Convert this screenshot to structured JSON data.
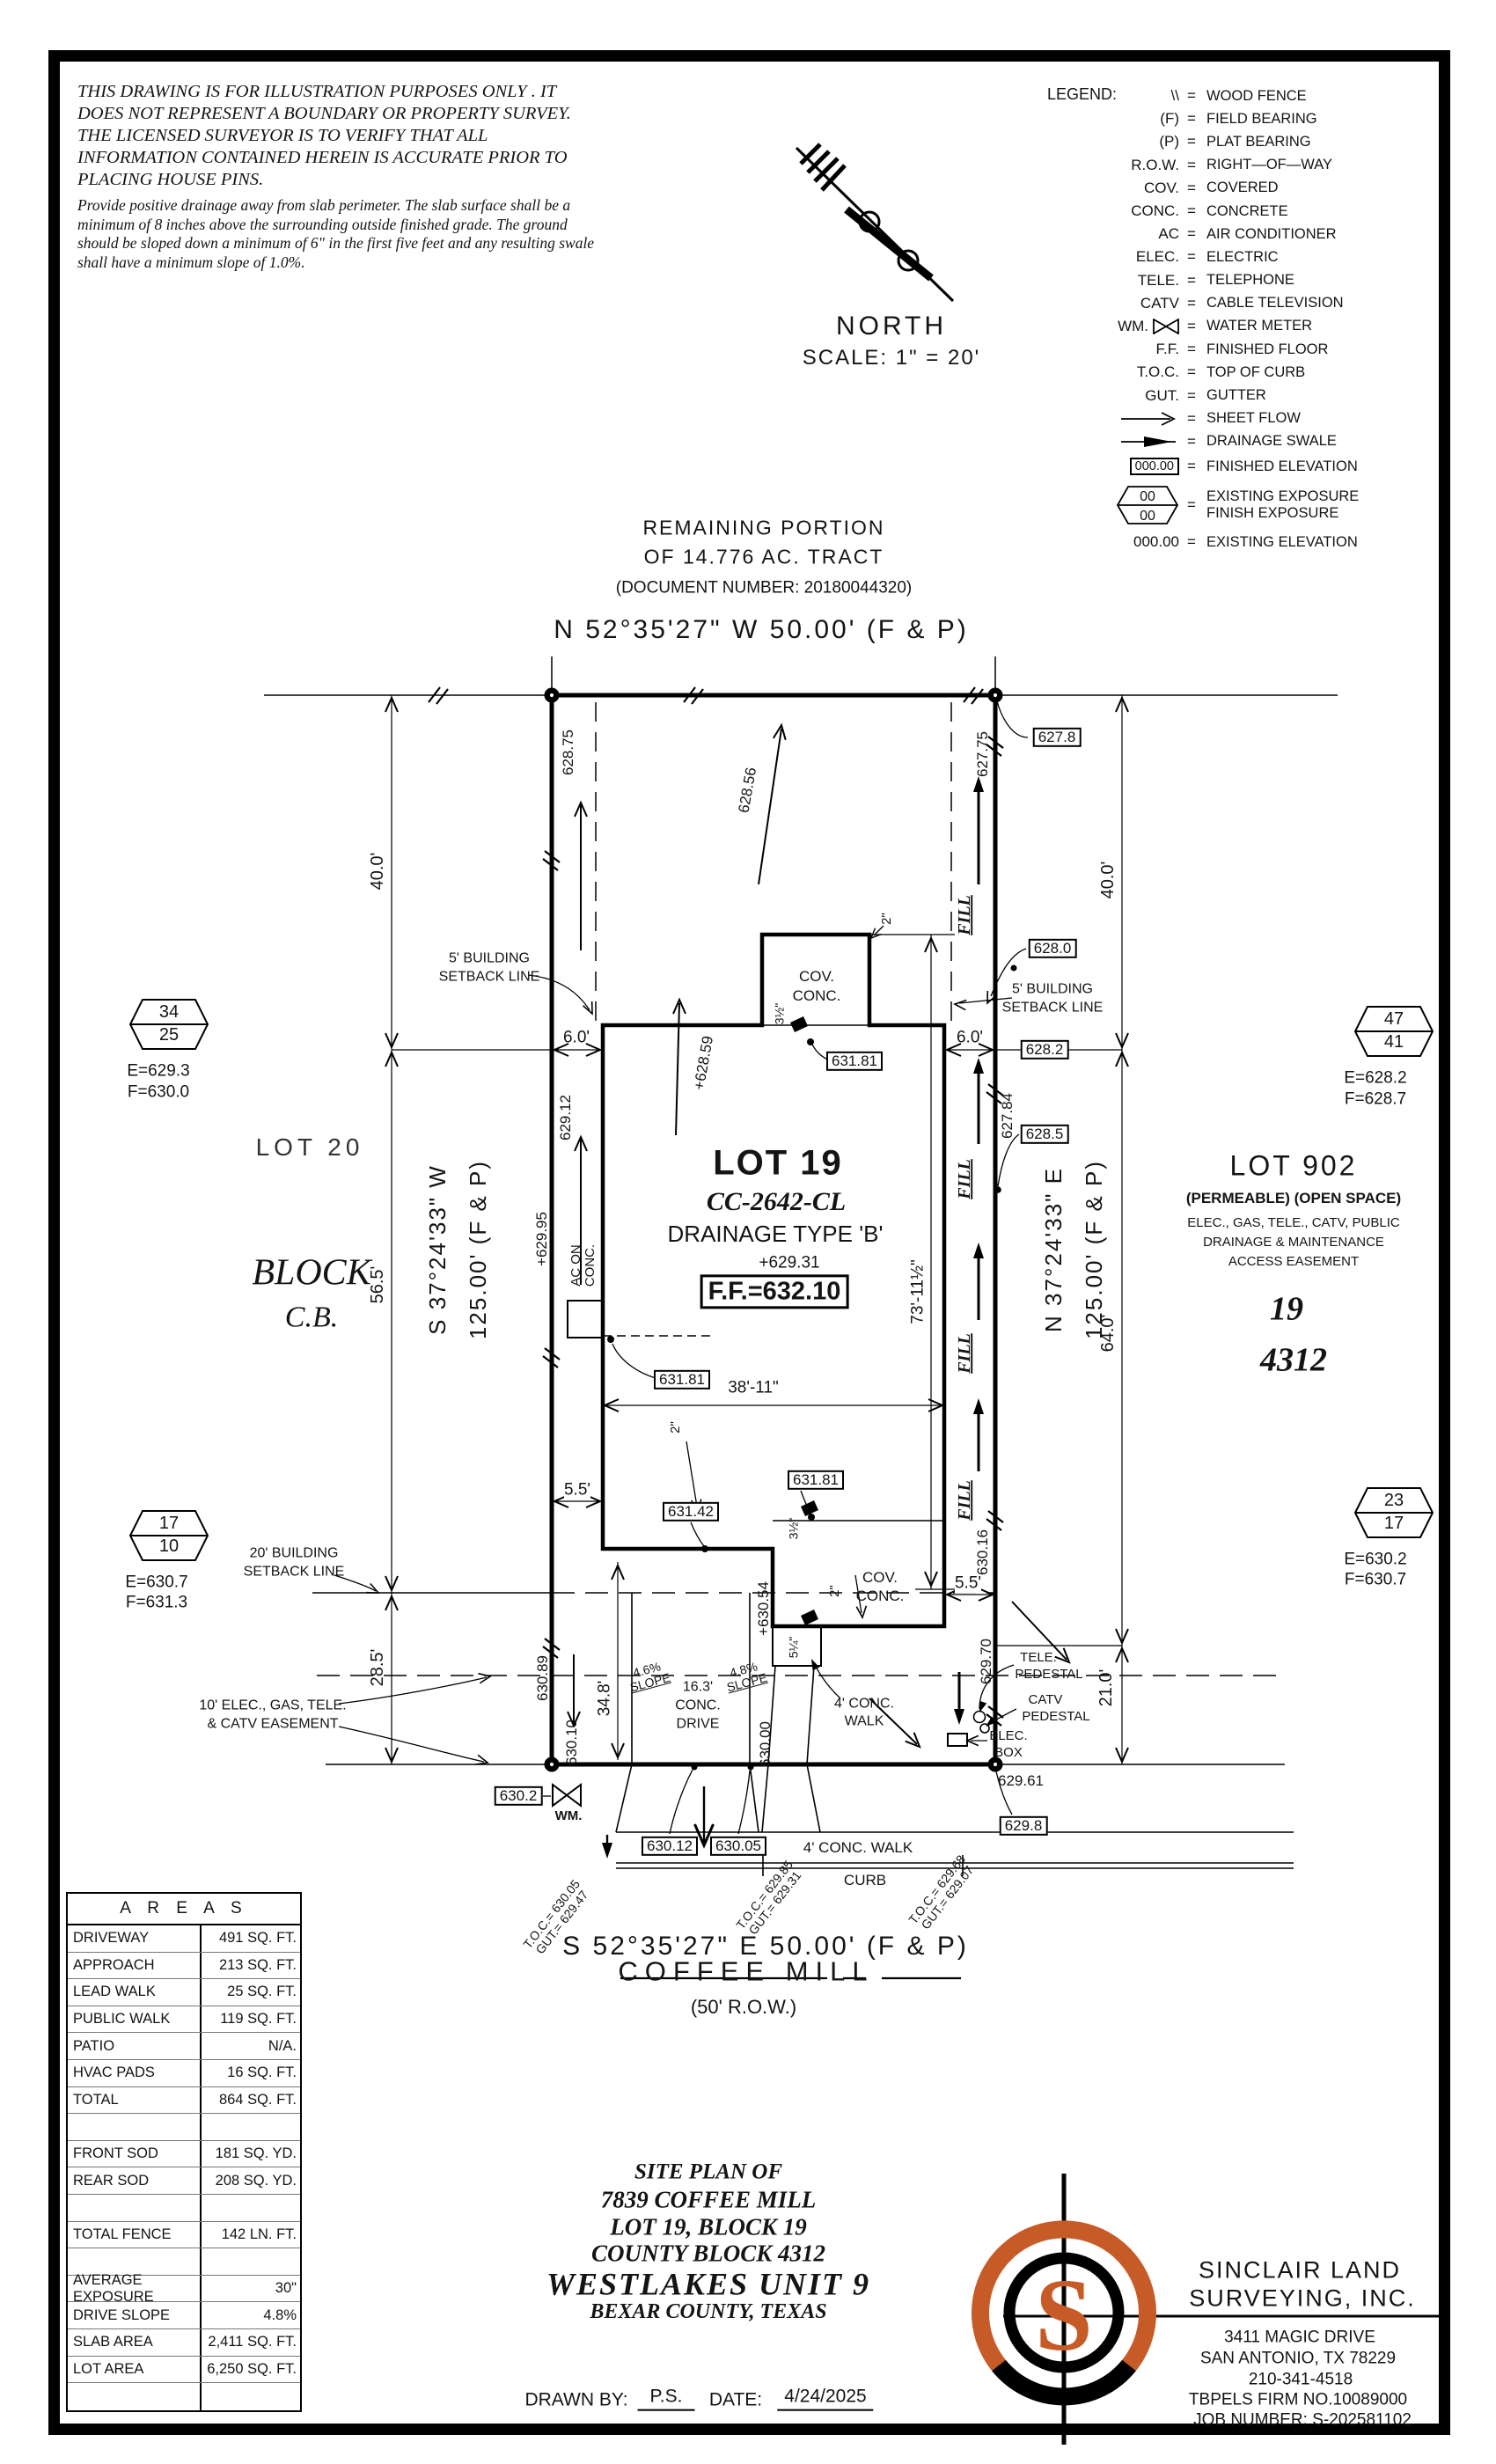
{
  "sheet": {
    "disclaimer_para1": "THIS DRAWING IS FOR ILLUSTRATION PURPOSES ONLY . IT DOES NOT REPRESENT A BOUNDARY OR PROPERTY SURVEY. THE LICENSED SURVEYOR IS TO VERIFY THAT ALL INFORMATION CONTAINED HEREIN IS ACCURATE PRIOR TO PLACING HOUSE PINS.",
    "disclaimer_para2": "Provide positive drainage away from slab perimeter. The slab surface shall be a minimum of 8 inches above the surrounding outside finished grade. The ground should be sloped down a minimum of 6\" in the first five feet and any resulting swale shall have a minimum slope of 1.0%."
  },
  "legend": {
    "title": "LEGEND:",
    "eq": "=",
    "hex_top": "00",
    "hex_bot": "00",
    "rows": [
      {
        "sym": "\\\\",
        "desc": "WOOD FENCE"
      },
      {
        "sym": "(F)",
        "desc": "FIELD BEARING"
      },
      {
        "sym": "(P)",
        "desc": "PLAT BEARING"
      },
      {
        "sym": "R.O.W.",
        "desc": "RIGHT—OF—WAY"
      },
      {
        "sym": "COV.",
        "desc": "COVERED"
      },
      {
        "sym": "CONC.",
        "desc": "CONCRETE"
      },
      {
        "sym": "AC",
        "desc": "AIR CONDITIONER"
      },
      {
        "sym": "ELEC.",
        "desc": "ELECTRIC"
      },
      {
        "sym": "TELE.",
        "desc": "TELEPHONE"
      },
      {
        "sym": "CATV",
        "desc": "CABLE TELEVISION"
      },
      {
        "sym": "WM.",
        "desc": "WATER METER"
      },
      {
        "sym": "F.F.",
        "desc": "FINISHED FLOOR"
      },
      {
        "sym": "T.O.C.",
        "desc": "TOP OF CURB"
      },
      {
        "sym": "GUT.",
        "desc": "GUTTER"
      },
      {
        "sym": "",
        "desc": "SHEET FLOW"
      },
      {
        "sym": "",
        "desc": "DRAINAGE SWALE"
      },
      {
        "sym": "000.00",
        "desc": "FINISHED ELEVATION"
      },
      {
        "sym": "",
        "desc": "EXISTING EXPOSURE",
        "desc2": "FINISH EXPOSURE"
      },
      {
        "sym": "000.00",
        "desc": "EXISTING ELEVATION"
      }
    ]
  },
  "north": {
    "label": "NORTH",
    "scale": "SCALE: 1\" = 20'"
  },
  "tract": {
    "line1": "REMAINING PORTION",
    "line2": "OF 14.776 AC. TRACT",
    "line3": "(DOCUMENT NUMBER: 20180044320)"
  },
  "bearing_north": "N 52°35'27\" W 50.00' (F & P)",
  "bearing_south": "S 52°35'27\" E 50.00' (F & P)",
  "bearing_west": {
    "dir": "S 37°24'33\" W",
    "len": "125.00' (F & P)"
  },
  "bearing_east": {
    "dir": "N 37°24'33\" E",
    "len": "125.00' (F & P)"
  },
  "street": {
    "name": "COFFEE MILL",
    "row": "(50' R.O.W.)",
    "walk": "4' CONC. WALK",
    "curb": "CURB"
  },
  "lot19": {
    "name": "LOT 19",
    "plan_code": "CC-2642-CL",
    "drainage": "DRAINAGE TYPE 'B'",
    "spot": "+629.31",
    "ff": "F.F.=632.10"
  },
  "lot20": {
    "name": "LOT 20",
    "block1": "BLOCK",
    "block2": "C.B."
  },
  "lot902": {
    "name": "LOT 902",
    "l1": "(PERMEABLE) (OPEN SPACE)",
    "l2": "ELEC., GAS, TELE., CATV, PUBLIC",
    "l3": "DRAINAGE & MAINTENANCE",
    "l4": "ACCESS EASEMENT",
    "block": "19",
    "county_block": "4312"
  },
  "hex": {
    "tl": {
      "top": "34",
      "bot": "25",
      "e": "E=629.3",
      "f": "F=630.0"
    },
    "tr": {
      "top": "47",
      "bot": "41",
      "e": "E=628.2",
      "f": "F=628.7"
    },
    "bl": {
      "top": "17",
      "bot": "10",
      "e": "E=630.7",
      "f": "F=631.3"
    },
    "br": {
      "top": "23",
      "bot": "17",
      "e": "E=630.2",
      "f": "F=630.7"
    }
  },
  "dims": {
    "d40l": "40.0'",
    "d40r": "40.0'",
    "d565": "56.5'",
    "d285": "28.5'",
    "d64": "64.0'",
    "d21": "21.0'",
    "d6l": "6.0'",
    "d6r": "6.0'",
    "d55l": "5.5'",
    "d55r": "5.5'",
    "d3811": "38'-11\"",
    "d7311": "73'-11½\"",
    "d348": "34.8'",
    "d2a": "2\"",
    "d2b": "2\"",
    "d2c": "2\"",
    "d35a": "3½\"",
    "d35b": "3½\"",
    "d525": "5¼\""
  },
  "setbacks": {
    "five_l1": "5' BUILDING",
    "five_l2": "SETBACK LINE",
    "twenty_l1": "20' BUILDING",
    "twenty_l2": "SETBACK LINE",
    "easement_l1": "10' ELEC., GAS, TELE.",
    "easement_l2": "& CATV EASEMENT"
  },
  "drive": {
    "slope1a": "4.6%",
    "slope1b": "SLOPE",
    "w1": "16.3'",
    "w2": "CONC.",
    "w3": "DRIVE",
    "slope2a": "4.8%",
    "slope2b": "SLOPE",
    "walk1": "4' CONC.",
    "walk2": "WALK"
  },
  "features": {
    "cov1a": "COV.",
    "cov1b": "CONC.",
    "cov2a": "COV.",
    "cov2b": "CONC.",
    "ac1": "AC ON",
    "ac2": "CONC.",
    "wm": "WM.",
    "fill": "FILL",
    "tele1": "TELE.",
    "tele2": "PEDESTAL",
    "catv1": "CATV",
    "catv2": "PEDESTAL",
    "elec1": "ELEC.",
    "elec2": "BOX"
  },
  "spot": {
    "e62875": "628.75",
    "e62856": "628.56",
    "e62775": "627.75",
    "e62912": "629.12",
    "e62859": "+628.59",
    "e62784": "627.84",
    "e62995": "+629.95",
    "e63054": "+630.54",
    "e63016": "630.16",
    "e62970": "629.70",
    "e63089": "630.89",
    "e63010": "630.10",
    "e63000": "630.00",
    "e62961": "629.61",
    "b6278": "627.8",
    "b6280": "628.0",
    "b6282": "628.2",
    "b6285": "628.5",
    "b63181a": "631.81",
    "b63181b": "631.81",
    "b63181c": "631.81",
    "b63142": "631.42",
    "b6302": "630.2",
    "b6298": "629.8",
    "b63012": "630.12",
    "b63005": "630.05"
  },
  "toc": {
    "c1l1": "T.O.C.= 630.05",
    "c1l2": "GUT.= 629.47",
    "c2l1": "T.O.C.= 629.85",
    "c2l2": "GUT.= 629.31",
    "c3l1": "T.O.C.= 629.68",
    "c3l2": "GUT.= 629.07"
  },
  "areas_table": {
    "title": "A R E A S",
    "rows": [
      {
        "label": "DRIVEWAY",
        "value": "491 SQ. FT."
      },
      {
        "label": "APPROACH",
        "value": "213 SQ. FT."
      },
      {
        "label": "LEAD WALK",
        "value": "25 SQ. FT."
      },
      {
        "label": "PUBLIC WALK",
        "value": "119 SQ. FT."
      },
      {
        "label": "PATIO",
        "value": "N/A."
      },
      {
        "label": "HVAC PADS",
        "value": "16 SQ. FT."
      },
      {
        "label": "TOTAL",
        "value": "864 SQ. FT."
      },
      {
        "label": "",
        "value": ""
      },
      {
        "label": "FRONT SOD",
        "value": "181 SQ. YD."
      },
      {
        "label": "REAR SOD",
        "value": "208 SQ. YD."
      },
      {
        "label": "",
        "value": ""
      },
      {
        "label": "TOTAL FENCE",
        "value": "142 LN. FT."
      },
      {
        "label": "",
        "value": ""
      },
      {
        "label": "AVERAGE EXPOSURE",
        "value": "30\""
      },
      {
        "label": "DRIVE SLOPE",
        "value": "4.8%"
      },
      {
        "label": "SLAB AREA",
        "value": "2,411 SQ. FT."
      },
      {
        "label": "LOT AREA",
        "value": "6,250 SQ. FT."
      },
      {
        "label": "",
        "value": ""
      }
    ]
  },
  "titleblock": {
    "l1": "SITE PLAN OF",
    "l2": "7839 COFFEE MILL",
    "l3": "LOT 19, BLOCK 19",
    "l4": "COUNTY BLOCK 4312",
    "l5": "WESTLAKES UNIT 9",
    "l6": "BEXAR COUNTY, TEXAS",
    "drawn_label": "DRAWN BY:",
    "drawn_value": "P.S.",
    "date_label": "DATE:",
    "date_value": "4/24/2025"
  },
  "company": {
    "name1": "SINCLAIR LAND",
    "name2": "SURVEYING, INC.",
    "addr1": "3411 MAGIC DRIVE",
    "addr2": "SAN ANTONIO, TX 78229",
    "phone": "210-341-4518",
    "firm": "TBPELS FIRM NO.10089000",
    "job": "JOB NUMBER: S-202581102",
    "logo_letter": "S"
  },
  "colors": {
    "accent_orange": "#c75b28",
    "ink": "#141414"
  }
}
